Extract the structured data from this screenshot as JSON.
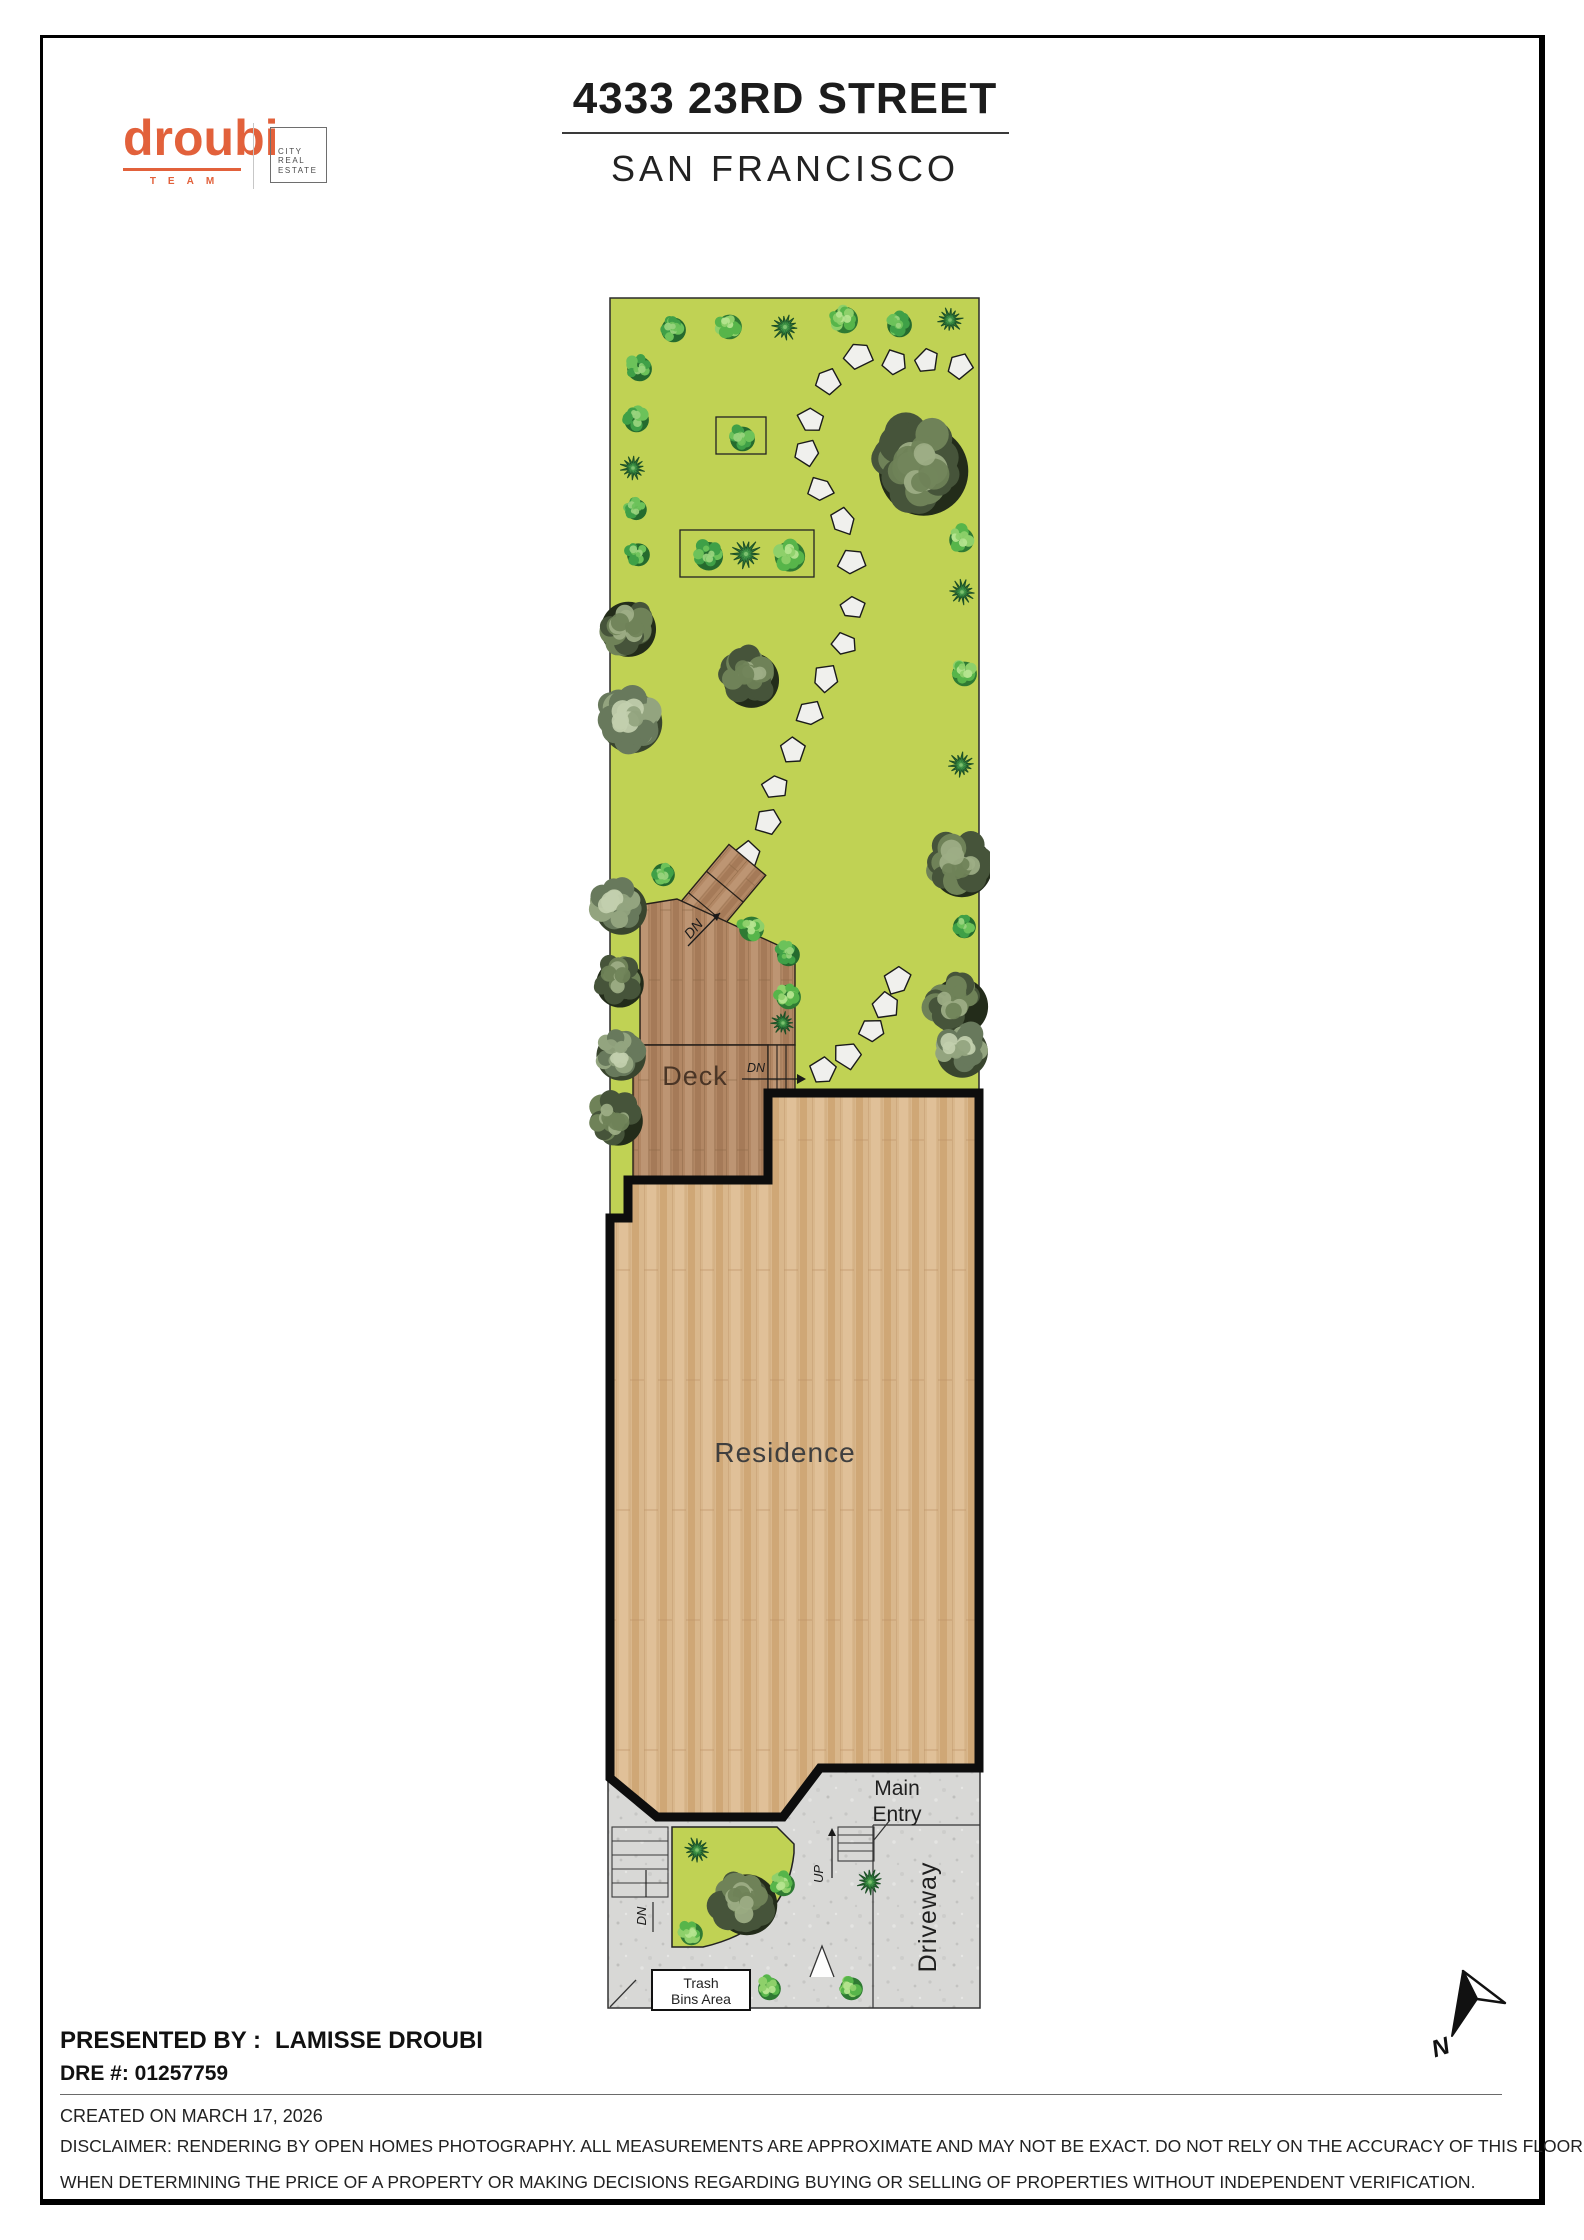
{
  "header": {
    "brand": {
      "wordmark": "droubi",
      "team": "TEAM",
      "box_lines": [
        "CITY",
        "REAL",
        "ESTATE"
      ]
    },
    "title": "4333 23RD STREET",
    "subtitle": "SAN FRANCISCO"
  },
  "plan": {
    "labels": {
      "deck": "Deck",
      "residence": "Residence",
      "main_entry_1": "Main",
      "main_entry_2": "Entry",
      "driveway": "Driveway",
      "trash_1": "Trash",
      "trash_2": "Bins Area",
      "dn": "DN",
      "up": "UP",
      "north": "N"
    },
    "colors": {
      "garden_green": "#c0d254",
      "deck_brown": "#b28764",
      "floor_wood": "#d9b78c",
      "concrete_gray": "#d8d8d6",
      "outline_black": "#0d0d0d",
      "accent_orange": "#e2613b"
    },
    "trees": [
      [
        672,
        328,
        13,
        "M"
      ],
      [
        728,
        325,
        13,
        "L"
      ],
      [
        785,
        327,
        13,
        "S"
      ],
      [
        843,
        318,
        14,
        "L"
      ],
      [
        898,
        323,
        13,
        "M"
      ],
      [
        950,
        320,
        12,
        "S"
      ],
      [
        638,
        367,
        13,
        "M"
      ],
      [
        635,
        418,
        13,
        "M"
      ],
      [
        633,
        468,
        12,
        "S"
      ],
      [
        635,
        508,
        11,
        "M"
      ],
      [
        637,
        553,
        12,
        "M"
      ],
      [
        741,
        437,
        13,
        "M"
      ],
      [
        707,
        554,
        15,
        "M"
      ],
      [
        746,
        554,
        14,
        "S"
      ],
      [
        788,
        554,
        16,
        "L"
      ],
      [
        918,
        464,
        47,
        "D"
      ],
      [
        960,
        538,
        13,
        "L"
      ],
      [
        962,
        592,
        12,
        "S"
      ],
      [
        963,
        672,
        13,
        "L"
      ],
      [
        961,
        765,
        12,
        "S"
      ],
      [
        625,
        625,
        29,
        "D"
      ],
      [
        628,
        718,
        32,
        "G"
      ],
      [
        748,
        676,
        29,
        "D"
      ],
      [
        618,
        905,
        27,
        "G"
      ],
      [
        617,
        980,
        25,
        "D"
      ],
      [
        618,
        1052,
        26,
        "G"
      ],
      [
        615,
        1117,
        26,
        "D"
      ],
      [
        958,
        862,
        32,
        "D"
      ],
      [
        963,
        925,
        12,
        "M"
      ],
      [
        956,
        1002,
        30,
        "D"
      ],
      [
        959,
        1048,
        27,
        "G"
      ],
      [
        662,
        873,
        12,
        "M"
      ],
      [
        750,
        927,
        13,
        "L"
      ],
      [
        787,
        953,
        12,
        "M"
      ],
      [
        787,
        995,
        13,
        "L"
      ],
      [
        783,
        1023,
        11,
        "S"
      ],
      [
        697,
        1850,
        12,
        "S"
      ],
      [
        743,
        1900,
        32,
        "D"
      ],
      [
        690,
        1932,
        12,
        "L"
      ],
      [
        782,
        1883,
        12,
        "L"
      ],
      [
        870,
        1882,
        12,
        "S"
      ],
      [
        850,
        1987,
        12,
        "L"
      ],
      [
        768,
        1987,
        12,
        "L"
      ]
    ],
    "stones": [
      [
        858,
        355
      ],
      [
        895,
        363
      ],
      [
        927,
        361
      ],
      [
        960,
        366
      ],
      [
        828,
        381
      ],
      [
        812,
        420
      ],
      [
        807,
        452
      ],
      [
        820,
        489
      ],
      [
        843,
        522
      ],
      [
        852,
        560
      ],
      [
        852,
        607
      ],
      [
        845,
        645
      ],
      [
        826,
        678
      ],
      [
        810,
        713
      ],
      [
        793,
        750
      ],
      [
        775,
        787
      ],
      [
        768,
        822
      ],
      [
        748,
        855
      ],
      [
        823,
        1071
      ],
      [
        848,
        1054
      ],
      [
        873,
        1031
      ],
      [
        887,
        1006
      ],
      [
        898,
        981
      ]
    ]
  },
  "footer": {
    "presented_by": "PRESENTED BY :",
    "agent": "LAMISSE DROUBI",
    "dre": "DRE #: 01257759",
    "created": "CREATED ON MARCH 17, 2026",
    "disclaimer": [
      "DISCLAIMER: RENDERING BY OPEN HOMES PHOTOGRAPHY. ALL MEASUREMENTS ARE APPROXIMATE AND MAY NOT BE EXACT. DO NOT RELY ON THE ACCURACY OF THIS FLOOR PLAN",
      "WHEN DETERMINING THE PRICE OF A PROPERTY OR MAKING DECISIONS REGARDING BUYING OR SELLING OF PROPERTIES WITHOUT INDEPENDENT VERIFICATION."
    ]
  }
}
